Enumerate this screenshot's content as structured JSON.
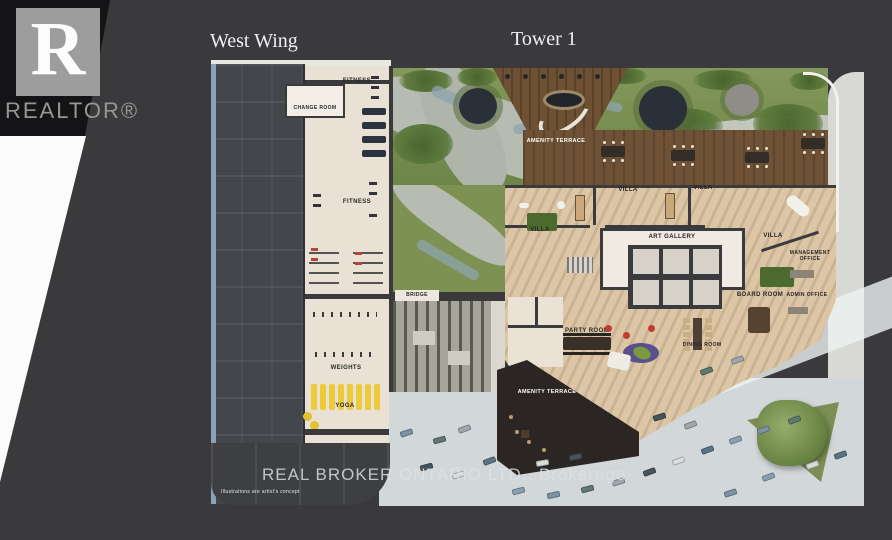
{
  "branding": {
    "logo_letter": "R",
    "logo_word": "REALTOR®",
    "logo_square_color": "#9d9d9d"
  },
  "titles": {
    "west_wing": "West Wing",
    "tower": "Tower 1"
  },
  "plan": {
    "labels": {
      "fitness_top": "FITNESS",
      "change_room": "CHANGE ROOM",
      "fitness_mid": "FITNESS",
      "weights": "WEIGHTS",
      "yoga": "YOGA",
      "bridge": "BRIDGE",
      "amenity_terrace_top": "AMENITY TERRACE",
      "amenity_terrace_bottom": "AMENITY TERRACE",
      "villa_1": "VILLA",
      "villa_2": "VILLA",
      "villa_3": "VILLA",
      "villa_4": "VILLA",
      "art_gallery": "ART GALLERY",
      "management_office": "MANAGEMENT OFFICE",
      "board_room": "BOARD ROOM",
      "admin_office": "ADMIN OFFICE",
      "party_room": "PARTY ROOM",
      "dining_room": "DINING ROOM"
    },
    "colors": {
      "background": "#3a3a3d",
      "west_wing_slab": "#43464b",
      "west_wing_edge_blue": "#8ba1b5",
      "fitness_floor": "#e9e1d3",
      "yoga_mat_yellow": "#ecca39",
      "terrace_green": "#7d9252",
      "deck_wood": "#6e5033",
      "villa_wood": "#dcc6a5",
      "gallery_white": "#f0eae2",
      "road_gray": "#d2d7d9",
      "dark_terrace": "#2b2624"
    }
  },
  "footer": {
    "brokerage": "REAL BROKER ONTARIO LTD., Brokerage",
    "disclaimer": "Illustrations are artist's concept"
  }
}
